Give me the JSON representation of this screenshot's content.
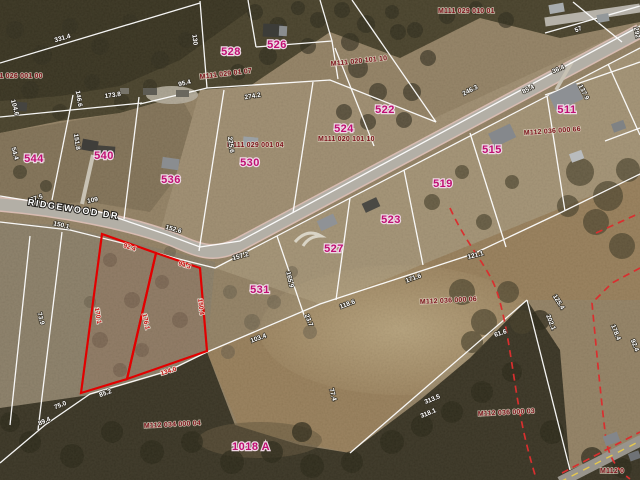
{
  "map": {
    "type": "parcel-aerial-view",
    "road_name": "RIDGEWOOD DR",
    "selected_parcel_color": "#e20000",
    "parcel_line_color": "#ffffff",
    "parcel_number_color": "#bf0f72",
    "parcel_id_color": "#7c141c",
    "dashed_line_color": "#d92f2f"
  },
  "road_labels": [
    {
      "t": "RIDGEWOOD DR",
      "x": 73,
      "y": 212,
      "r": 9
    }
  ],
  "parcel_numbers": [
    {
      "t": "528",
      "x": 231,
      "y": 55
    },
    {
      "t": "526",
      "x": 277,
      "y": 48
    },
    {
      "t": "544",
      "x": 34,
      "y": 162
    },
    {
      "t": "540",
      "x": 104,
      "y": 159
    },
    {
      "t": "536",
      "x": 171,
      "y": 183
    },
    {
      "t": "530",
      "x": 250,
      "y": 166
    },
    {
      "t": "524",
      "x": 344,
      "y": 132
    },
    {
      "t": "522",
      "x": 385,
      "y": 113
    },
    {
      "t": "511",
      "x": 567,
      "y": 113
    },
    {
      "t": "515",
      "x": 492,
      "y": 153
    },
    {
      "t": "519",
      "x": 443,
      "y": 187
    },
    {
      "t": "523",
      "x": 391,
      "y": 223
    },
    {
      "t": "527",
      "x": 334,
      "y": 252
    },
    {
      "t": "531",
      "x": 260,
      "y": 293
    },
    {
      "t": "1018 A",
      "x": 251,
      "y": 450
    }
  ],
  "parcel_ids": [
    {
      "t": "M111 026 001 00",
      "x": -14,
      "y": 78
    },
    {
      "t": "M111 029 01 07",
      "x": 200,
      "y": 79,
      "r": -7
    },
    {
      "t": "M111 029 010 01",
      "x": 438,
      "y": 13
    },
    {
      "t": "M111 020 101 10",
      "x": 331,
      "y": 66,
      "r": -6
    },
    {
      "t": "M111 020 101 10",
      "x": 318,
      "y": 141
    },
    {
      "t": "M111 029 001 04",
      "x": 227,
      "y": 147
    },
    {
      "t": "M112 036 000 66",
      "x": 524,
      "y": 135,
      "r": -4
    },
    {
      "t": "M112 036 000 06",
      "x": 420,
      "y": 304,
      "r": -3
    },
    {
      "t": "M112 036 000 03",
      "x": 478,
      "y": 416,
      "r": -3
    },
    {
      "t": "M112 034 000 04",
      "x": 144,
      "y": 428,
      "r": -3
    },
    {
      "t": "M112 0",
      "x": 600,
      "y": 473
    }
  ],
  "dimensions_white": [
    {
      "t": "331.4",
      "x": 63,
      "y": 40,
      "r": -16
    },
    {
      "t": "130",
      "x": 193,
      "y": 40,
      "r": 84
    },
    {
      "t": "95.4",
      "x": 185,
      "y": 85,
      "r": -14
    },
    {
      "t": "274.2",
      "x": 253,
      "y": 98,
      "r": -10
    },
    {
      "t": "146.6",
      "x": 77,
      "y": 99,
      "r": 80
    },
    {
      "t": "173.8",
      "x": 113,
      "y": 97,
      "r": -8
    },
    {
      "t": "104.6",
      "x": 13,
      "y": 108,
      "r": 75
    },
    {
      "t": "54.4",
      "x": 13,
      "y": 154,
      "r": 75
    },
    {
      "t": "151.8",
      "x": 75,
      "y": 142,
      "r": 82
    },
    {
      "t": "225.6",
      "x": 229,
      "y": 145,
      "r": 82
    },
    {
      "t": "97.5",
      "x": 37,
      "y": 200,
      "r": -18
    },
    {
      "t": "109",
      "x": 93,
      "y": 202,
      "r": -12
    },
    {
      "t": "150.1",
      "x": 61,
      "y": 227,
      "r": 12
    },
    {
      "t": "152.6",
      "x": 173,
      "y": 231,
      "r": 16
    },
    {
      "t": "246.3",
      "x": 471,
      "y": 92,
      "r": -27
    },
    {
      "t": "85.4",
      "x": 529,
      "y": 91,
      "r": -27
    },
    {
      "t": "36.4",
      "x": 559,
      "y": 71,
      "r": -24
    },
    {
      "t": "57",
      "x": 579,
      "y": 31,
      "r": -24
    },
    {
      "t": "292",
      "x": 635,
      "y": 33,
      "r": 80
    },
    {
      "t": "137.9",
      "x": 582,
      "y": 93,
      "r": 63
    },
    {
      "t": "23.7",
      "x": 307,
      "y": 321,
      "r": 68
    },
    {
      "t": "103.4",
      "x": 259,
      "y": 340,
      "r": -20
    },
    {
      "t": "157.2",
      "x": 241,
      "y": 258,
      "r": -16
    },
    {
      "t": "165.9",
      "x": 288,
      "y": 280,
      "r": 78
    },
    {
      "t": "121.1",
      "x": 476,
      "y": 257,
      "r": -14
    },
    {
      "t": "171.6",
      "x": 414,
      "y": 280,
      "r": -20
    },
    {
      "t": "118.6",
      "x": 348,
      "y": 306,
      "r": -20
    },
    {
      "t": "125.4",
      "x": 557,
      "y": 303,
      "r": 58
    },
    {
      "t": "202.1",
      "x": 549,
      "y": 323,
      "r": 68
    },
    {
      "t": "61.6",
      "x": 501,
      "y": 335,
      "r": -18
    },
    {
      "t": "178.4",
      "x": 614,
      "y": 333,
      "r": 68
    },
    {
      "t": "92.4",
      "x": 633,
      "y": 346,
      "r": 68
    },
    {
      "t": "313.5",
      "x": 433,
      "y": 401,
      "r": -22
    },
    {
      "t": "318.1",
      "x": 429,
      "y": 415,
      "r": -22
    },
    {
      "t": "77.4",
      "x": 331,
      "y": 395,
      "r": 75
    },
    {
      "t": "73.9",
      "x": 39,
      "y": 319,
      "r": 75
    },
    {
      "t": "75.0",
      "x": 61,
      "y": 407,
      "r": -22
    },
    {
      "t": "85.2",
      "x": 106,
      "y": 395,
      "r": -20
    },
    {
      "t": "89.4",
      "x": 45,
      "y": 423,
      "r": -24
    }
  ],
  "dimensions_red": [
    {
      "t": "92.4",
      "x": 129,
      "y": 249,
      "r": 19
    },
    {
      "t": "94.3",
      "x": 184,
      "y": 267,
      "r": 17
    },
    {
      "t": "170.1",
      "x": 96,
      "y": 316,
      "r": 81
    },
    {
      "t": "176.1",
      "x": 144,
      "y": 322,
      "r": 78
    },
    {
      "t": "150.4",
      "x": 199,
      "y": 307,
      "r": 84
    },
    {
      "t": "134.0",
      "x": 169,
      "y": 373,
      "r": -17
    }
  ]
}
